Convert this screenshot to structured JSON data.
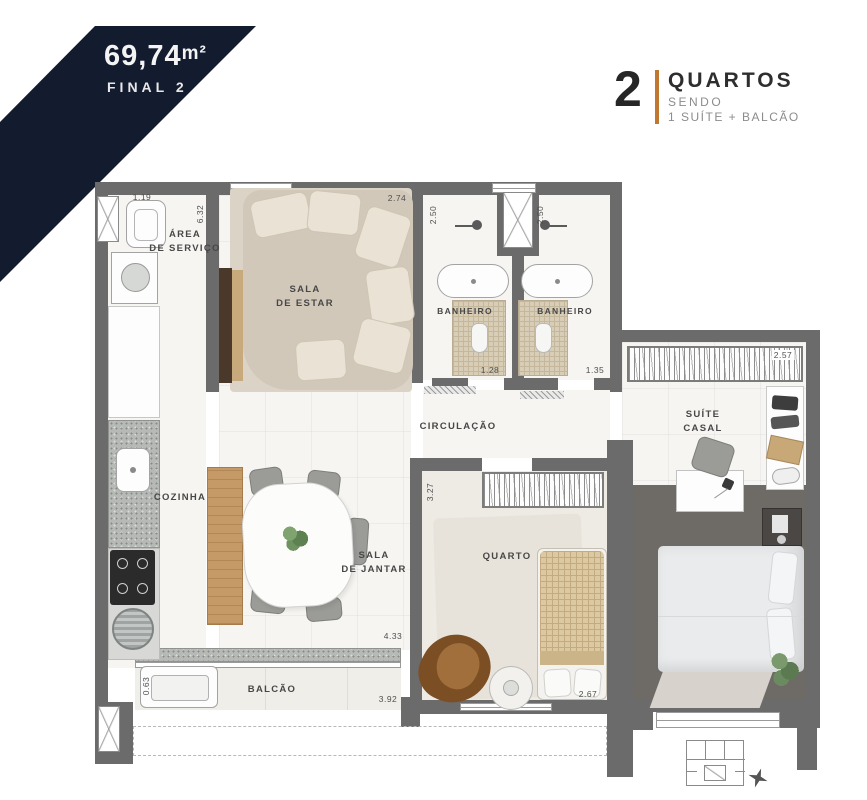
{
  "badge": {
    "area_value": "69,74",
    "area_unit": "m²",
    "final": "FINAL 2"
  },
  "header": {
    "number": "2",
    "title": "QUARTOS",
    "subtitle": "SENDO",
    "detail": "1 SUÍTE + BALCÃO"
  },
  "rooms": {
    "area_servico": "ÁREA\nDE SERVIÇO",
    "sala_estar": "SALA\nDE ESTAR",
    "banheiro1": "BANHEIRO",
    "banheiro2": "BANHEIRO",
    "suite_casal": "SUÍTE\nCASAL",
    "circulacao": "CIRCULAÇÃO",
    "cozinha": "COZINHA",
    "sala_jantar": "SALA\nDE JANTAR",
    "quarto": "QUARTO",
    "balcao": "BALCÃO"
  },
  "dims": {
    "servico_width": "1.19",
    "servico_height": "6.32",
    "estar_width": "2.74",
    "banheiro1_height": "2.50",
    "banheiro2_height": "2.50",
    "suite_closet_width": "2.57",
    "banheiro1_width": "1.28",
    "banheiro2_width": "1.35",
    "quarto_height": "3.27",
    "jantar_length": "4.33",
    "quarto_width": "2.67",
    "balcao_width": "3.92",
    "balcao_depth": "0.63"
  },
  "colors": {
    "navy": "#131b2e",
    "accent": "#c0772f",
    "wall_gray": "#6b6b6b"
  }
}
